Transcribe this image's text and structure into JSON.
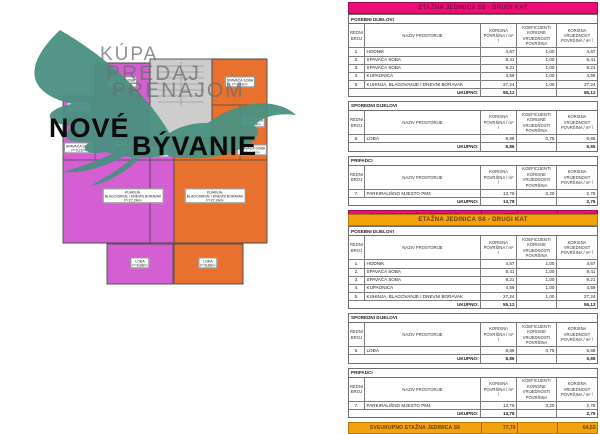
{
  "colors": {
    "unit_left_fill": "#d35fd3",
    "unit_right_fill": "#e8712d",
    "stair_fill": "#cdcdcd",
    "table_pink": "#ec0e77",
    "table_orange": "#f2a20d",
    "logo_teal": "#4a9181"
  },
  "logo": {
    "gray_lines": [
      "KÚPA",
      "PREDAJ",
      "PRENÁJOM"
    ],
    "brand_top": "NOVÉ",
    "brand_bottom": "BÝVANIE"
  },
  "floorplan": {
    "unit_left": {
      "badge": "S5",
      "rooms": {
        "bedroom1": {
          "name": "SPAVAĆA SOBA",
          "area": "P=9,41m²"
        },
        "bathroom": {
          "name": "KUPAONICA",
          "area": "P=4,59m²"
        },
        "bedroom2": {
          "name": "SPAVAĆA SOBA",
          "area": "P=9,21m²"
        },
        "hall": {
          "name": "HODNIK",
          "area": "P=4,67m²"
        },
        "living": {
          "name": "KUHINJA,",
          "name2": "BLAGOVANJE I DNEVNI BORAVAK",
          "area": "P=27,24m²"
        },
        "loggia": {
          "name": "LOĐA",
          "area": "P=8,86m²"
        }
      }
    },
    "unit_right": {
      "badge": "S6",
      "rooms": {
        "bedroom1": {
          "name": "SPAVAĆA SOBA",
          "area": "P=9,41m²"
        },
        "bathroom": {
          "name": "KUPAONICA",
          "area": "P=4,59m²"
        },
        "bedroom2": {
          "name": "SPAVAĆA SOBA",
          "area": "P=9,21m²"
        },
        "hall": {
          "name": "HODNIK",
          "area": "P=4,67m²"
        },
        "living": {
          "name": "KUHINJA,",
          "name2": "BLAGOVANJE I DNEVNI BORAVAK",
          "area": "P=27,24m²"
        },
        "loggia": {
          "name": "LOĐA",
          "area": "P=8,86m²"
        }
      }
    }
  },
  "col_headers": [
    "REDNI BROJ",
    "NAZIV PROSTORIJE",
    "KORISNA POVRŠINA / m² /",
    "KOEFICIJENTI KORISNE VRIJEDNOSTI POVRŠINA",
    "KORISNA VRIJEDNOST POVRŠINA / m² /"
  ],
  "tables": [
    {
      "title": "ETAŽNA JEDINICA S5 - DRUGI KAT",
      "accent": "#ec0e77",
      "accent_border": "#a50b56",
      "header_text": "#7c1038",
      "sections": [
        {
          "label": "POSEBNI DIJELOVI",
          "rows": [
            [
              "1.",
              "HODNIK",
              "4,67",
              "1,00",
              "4,67"
            ],
            [
              "2.",
              "SPAVAĆA SOBA",
              "9,41",
              "1,00",
              "9,41"
            ],
            [
              "3.",
              "SPAVAĆA SOBA",
              "9,21",
              "1,00",
              "9,21"
            ],
            [
              "4.",
              "KUPAONICA",
              "4,59",
              "1,00",
              "4,59"
            ],
            [
              "5.",
              "KUHINJA, BLAGOVANJE I DNEVNI BORAVAK",
              "27,24",
              "1,00",
              "27,24"
            ]
          ],
          "total_label": "UKUPNO:",
          "total_korisna": "55,12",
          "total_vrijednost": "55,12"
        },
        {
          "label": "SPOREDNI DIJELOVI",
          "rows": [
            [
              "6.",
              "LOĐA",
              "8,86",
              "0,75",
              "6,65"
            ]
          ],
          "total_label": "UKUPNO:",
          "total_korisna": "8,86",
          "total_vrijednost": "6,65"
        },
        {
          "label": "PRIPADCI",
          "rows": [
            [
              "7.",
              "PARKIRALIŠNO MJESTO PM3",
              "13,78",
              "0,20",
              "2,76"
            ]
          ],
          "total_label": "UKUPNO:",
          "total_korisna": "13,78",
          "total_vrijednost": "2,76"
        }
      ],
      "grand_total": {
        "label": "SVEUKUPNO ETAŽNA JEDINICA S5",
        "korisna": "77,76",
        "vrijednost": "64,53"
      }
    },
    {
      "title": "ETAŽNA JEDINICA S6 - DRUGI KAT",
      "accent": "#f2a20d",
      "accent_border": "#b87700",
      "header_text": "#6b3a00",
      "sections": [
        {
          "label": "POSEBNI DIJELOVI",
          "rows": [
            [
              "1.",
              "HODNIK",
              "4,67",
              "1,00",
              "4,67"
            ],
            [
              "2.",
              "SPAVAĆA SOBA",
              "9,41",
              "1,00",
              "9,41"
            ],
            [
              "3.",
              "SPAVAĆA SOBA",
              "9,21",
              "1,00",
              "9,21"
            ],
            [
              "4.",
              "KUPAONICA",
              "4,59",
              "1,00",
              "4,59"
            ],
            [
              "5.",
              "KUHINJA, BLAGOVANJE I DNEVNI BORAVAK",
              "27,24",
              "1,00",
              "27,24"
            ]
          ],
          "total_label": "UKUPNO:",
          "total_korisna": "55,12",
          "total_vrijednost": "55,12"
        },
        {
          "label": "SPOREDNI DIJELOVI",
          "rows": [
            [
              "6.",
              "LOĐA",
              "8,86",
              "0,75",
              "6,65"
            ]
          ],
          "total_label": "UKUPNO:",
          "total_korisna": "8,86",
          "total_vrijednost": "6,65"
        },
        {
          "label": "PRIPADCI",
          "rows": [
            [
              "7.",
              "PARKIRALIŠNO MJESTO PM4",
              "13,78",
              "0,20",
              "2,76"
            ]
          ],
          "total_label": "UKUPNO:",
          "total_korisna": "13,78",
          "total_vrijednost": "2,76"
        }
      ],
      "grand_total": {
        "label": "SVEUKUPNO ETAŽNA JEDINICA S6",
        "korisna": "77,76",
        "vrijednost": "64,53"
      }
    }
  ]
}
